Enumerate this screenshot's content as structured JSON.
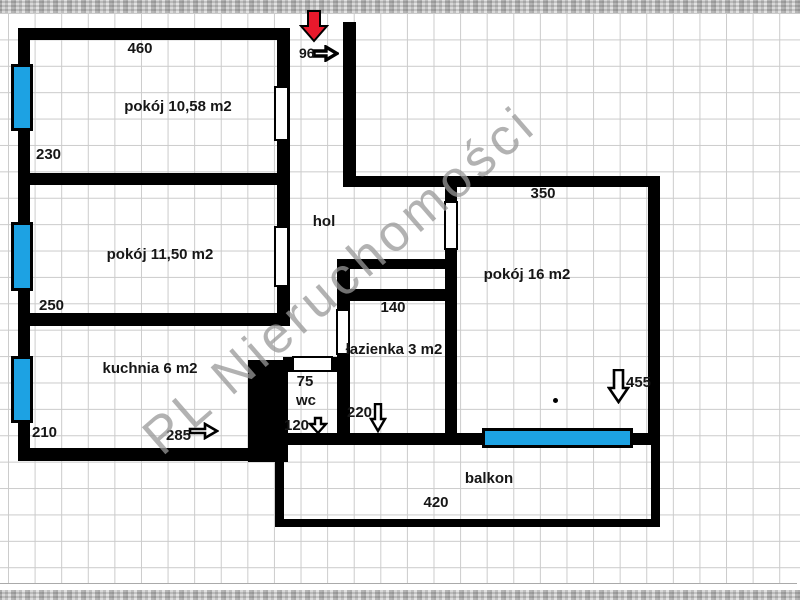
{
  "watermark": {
    "text": "PL Nieruchomości"
  },
  "plan": {
    "rooms": {
      "pokoj1": "pokój 10,58 m2",
      "pokoj2": "pokój 11,50 m2",
      "pokoj3": "pokój 16 m2",
      "kuchnia": "kuchnia 6 m2",
      "lazienka": "łazienka 3 m2",
      "wc": "wc",
      "hol": "hol",
      "balkon": "balkon"
    },
    "dimensions": {
      "pokoj1_width": "460",
      "pokoj1_height": "230",
      "pokoj2_height": "250",
      "kuchnia_height": "210",
      "kuchnia_width": "285",
      "entrance_door": "96",
      "wc_width": "75",
      "wc_height": "120",
      "lazienka_width": "140",
      "lazienka_height": "220",
      "pokoj3_width": "350",
      "pokoj3_height": "455",
      "balkon_width": "420"
    },
    "colors": {
      "wall": "#000000",
      "window": "#1da2e3",
      "entrance_arrow": "#e8192c",
      "grid": "#cbcbcb"
    }
  }
}
